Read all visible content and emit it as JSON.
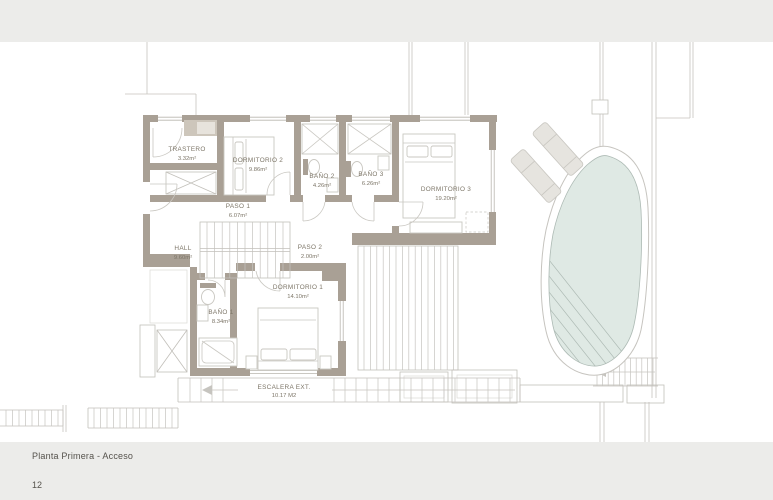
{
  "footer": {
    "title": "Planta Primera - Acceso",
    "page_number": "12"
  },
  "rooms": [
    {
      "name": "TRASTERO",
      "area": "3.32m²"
    },
    {
      "name": "DORMITORIO 2",
      "area": "9.86m²"
    },
    {
      "name": "BAÑO 2",
      "area": "4.26m²"
    },
    {
      "name": "BAÑO 3",
      "area": "6.26m²"
    },
    {
      "name": "DORMITORIO 3",
      "area": "19.20m²"
    },
    {
      "name": "PASO 1",
      "area": "6.07m²"
    },
    {
      "name": "HALL",
      "area": "9.60m²"
    },
    {
      "name": "PASO 2",
      "area": "2.00m²"
    },
    {
      "name": "DORMITORIO 1",
      "area": "14.10m²"
    },
    {
      "name": "BAÑO 1",
      "area": "8.34m²"
    },
    {
      "name": "ESCALERA EXT.",
      "area": "10.17 M2"
    }
  ],
  "colors": {
    "band": "#ececea",
    "wall": "#a9a095",
    "wall-light": "#cdc6bb",
    "line": "#c2c0ba",
    "furn": "#c9c7c1",
    "furn-fill": "#e6e4df",
    "site": "#c6c4bf",
    "win": "#b9b6af",
    "pool": "#dfe9e4",
    "pool-edge": "#adbab4",
    "label": "#7d7668",
    "footer-text": "#55524c"
  }
}
